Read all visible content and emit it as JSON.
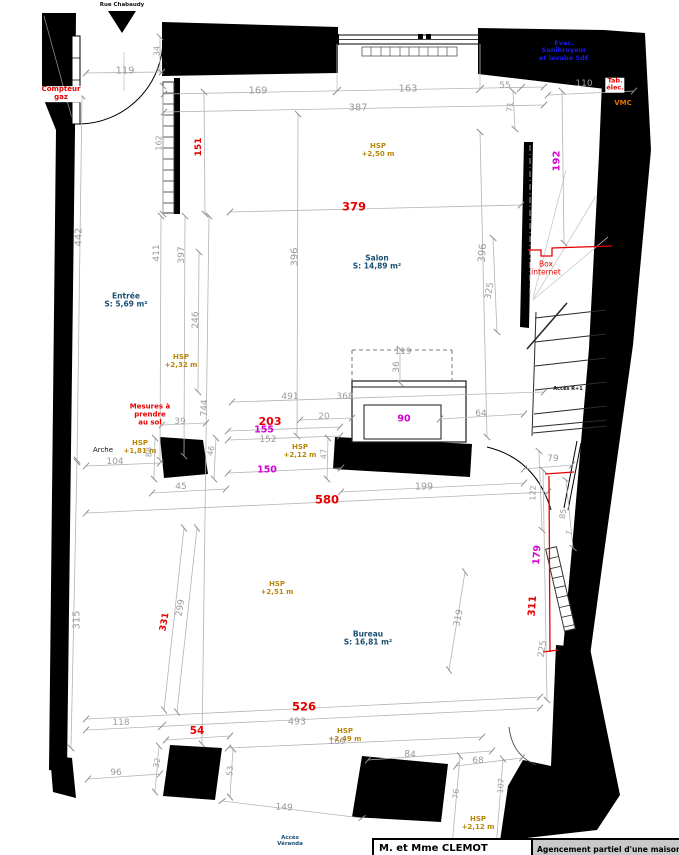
{
  "colors": {
    "dim": "#9b9b9b",
    "red": "#e60000",
    "magenta": "#d400d4",
    "hsp": "#b8860b",
    "room": "#1b4f72",
    "blue": "#1a1ae6",
    "orange": "#e67300",
    "black": "#111111"
  },
  "title_block": {
    "client": "M. et Mme CLEMOT",
    "project": "Agencement partiel d'une maison d'hab"
  },
  "labels": [
    {
      "name": "street-label",
      "text": "Rue Chabaudy",
      "x": 122,
      "y": 5,
      "color": "black",
      "size": 5.5,
      "bold": true
    },
    {
      "name": "compteur-gaz-label",
      "text": "Compteur\ngaz",
      "x": 61,
      "y": 94,
      "color": "red",
      "size": 7,
      "bold": true,
      "bg": true
    },
    {
      "name": "dim-119-top",
      "text": "119",
      "x": 125,
      "y": 71,
      "color": "dim",
      "size": 10
    },
    {
      "name": "dim-34",
      "text": "34",
      "x": 158,
      "y": 51,
      "color": "dim",
      "size": 8,
      "rot": -90
    },
    {
      "name": "dim-169-top",
      "text": "169",
      "x": 258,
      "y": 91,
      "color": "dim",
      "size": 10
    },
    {
      "name": "dim-163",
      "text": "163",
      "x": 408,
      "y": 89,
      "color": "dim",
      "size": 10
    },
    {
      "name": "dim-55",
      "text": "55",
      "x": 505,
      "y": 86,
      "color": "dim",
      "size": 9
    },
    {
      "name": "dim-110",
      "text": "110",
      "x": 584,
      "y": 84,
      "color": "dim",
      "size": 9
    },
    {
      "name": "dim-387",
      "text": "387",
      "x": 358,
      "y": 108,
      "color": "dim",
      "size": 10
    },
    {
      "name": "dim-71",
      "text": "71",
      "x": 511,
      "y": 107,
      "color": "dim",
      "size": 8,
      "rot": -85
    },
    {
      "name": "evac-note",
      "text": "Evac.\nSanibroyeur\net lavabo SdE",
      "x": 564,
      "y": 51,
      "color": "blue",
      "size": 6.5,
      "bold": true
    },
    {
      "name": "tab-elec-label",
      "text": "Tab.\nélec.",
      "x": 615,
      "y": 85,
      "color": "red",
      "size": 6.5,
      "bold": true,
      "bg": true
    },
    {
      "name": "vmc-label",
      "text": "VMC",
      "x": 623,
      "y": 104,
      "color": "orange",
      "size": 7,
      "bold": true
    },
    {
      "name": "dim-162",
      "text": "162",
      "x": 160,
      "y": 143,
      "color": "dim",
      "size": 8,
      "rot": -90
    },
    {
      "name": "dim-151",
      "text": "151",
      "x": 199,
      "y": 147,
      "color": "red",
      "size": 9,
      "rot": -90,
      "bold": true
    },
    {
      "name": "dim-192",
      "text": "192",
      "x": 557,
      "y": 161,
      "color": "magenta",
      "size": 10,
      "rot": -90,
      "bold": true
    },
    {
      "name": "hsp-salon",
      "text": "HSP\n+2,50 m",
      "x": 378,
      "y": 151,
      "color": "hsp",
      "size": 7,
      "bold": true
    },
    {
      "name": "dim-379",
      "text": "379",
      "x": 354,
      "y": 207,
      "color": "red",
      "size": 11.5,
      "bold": true
    },
    {
      "name": "dim-442",
      "text": "442",
      "x": 79,
      "y": 237,
      "color": "dim",
      "size": 10,
      "rot": -90
    },
    {
      "name": "dim-411",
      "text": "411",
      "x": 157,
      "y": 253,
      "color": "dim",
      "size": 9,
      "rot": -90
    },
    {
      "name": "dim-397",
      "text": "397",
      "x": 182,
      "y": 255,
      "color": "dim",
      "size": 9,
      "rot": -90
    },
    {
      "name": "dim-396-left",
      "text": "396",
      "x": 295,
      "y": 257,
      "color": "dim",
      "size": 10,
      "rot": -90
    },
    {
      "name": "dim-396-right",
      "text": "396",
      "x": 483,
      "y": 253,
      "color": "dim",
      "size": 10,
      "rot": -86
    },
    {
      "name": "dim-325",
      "text": "325",
      "x": 490,
      "y": 291,
      "color": "dim",
      "size": 9,
      "rot": -80
    },
    {
      "name": "room-label-salon",
      "text": "Salon\nS: 14,89 m²",
      "x": 377,
      "y": 263,
      "color": "room",
      "size": 7.5,
      "bold": true
    },
    {
      "name": "room-label-entree",
      "text": "Entrée\nS: 5,69 m²",
      "x": 126,
      "y": 301,
      "color": "room",
      "size": 7.5,
      "bold": true
    },
    {
      "name": "box-internet-label",
      "text": "Box\ninternet",
      "x": 546,
      "y": 269,
      "color": "red",
      "size": 7.5
    },
    {
      "name": "dim-246",
      "text": "246",
      "x": 196,
      "y": 320,
      "color": "dim",
      "size": 9,
      "rot": -90
    },
    {
      "name": "hsp-entree",
      "text": "HSP\n+2,32 m",
      "x": 181,
      "y": 362,
      "color": "hsp",
      "size": 7,
      "bold": true
    },
    {
      "name": "dim-36",
      "text": "36",
      "x": 397,
      "y": 367,
      "color": "dim",
      "size": 9,
      "rot": -90
    },
    {
      "name": "acces-r1-label",
      "text": "Accès R+1",
      "x": 568,
      "y": 390,
      "color": "black",
      "size": 5,
      "bold": true
    },
    {
      "name": "dim-491",
      "text": "491",
      "x": 290,
      "y": 397,
      "color": "dim",
      "size": 9
    },
    {
      "name": "dim-368",
      "text": "368",
      "x": 345,
      "y": 397,
      "color": "dim",
      "size": 9
    },
    {
      "name": "dim-119-fireplace",
      "text": "119",
      "x": 403,
      "y": 352,
      "color": "dim",
      "size": 9
    },
    {
      "name": "dim-744",
      "text": "744",
      "x": 205,
      "y": 408,
      "color": "dim",
      "size": 9,
      "rot": -88
    },
    {
      "name": "mesures-note",
      "text": "Mesures à\nprendre\nau sol",
      "x": 150,
      "y": 415,
      "color": "red",
      "size": 7,
      "bold": true
    },
    {
      "name": "dim-39",
      "text": "39",
      "x": 180,
      "y": 422,
      "color": "dim",
      "size": 9
    },
    {
      "name": "dim-20",
      "text": "20",
      "x": 324,
      "y": 417,
      "color": "dim",
      "size": 9
    },
    {
      "name": "dim-90",
      "text": "90",
      "x": 404,
      "y": 420,
      "color": "magenta",
      "size": 9.5,
      "bold": true
    },
    {
      "name": "dim-64",
      "text": "64",
      "x": 481,
      "y": 414,
      "color": "dim",
      "size": 9
    },
    {
      "name": "dim-203",
      "text": "203",
      "x": 270,
      "y": 422,
      "color": "red",
      "size": 11,
      "bold": true
    },
    {
      "name": "dim-155",
      "text": "155",
      "x": 264,
      "y": 431,
      "color": "magenta",
      "size": 9.5,
      "bold": true
    },
    {
      "name": "dim-152",
      "text": "152",
      "x": 268,
      "y": 440,
      "color": "dim",
      "size": 9
    },
    {
      "name": "arche-label",
      "text": "Arche",
      "x": 103,
      "y": 451,
      "color": "black",
      "size": 7
    },
    {
      "name": "hsp-arche",
      "text": "HSP\n+1,81 m",
      "x": 140,
      "y": 448,
      "color": "hsp",
      "size": 7,
      "bold": true
    },
    {
      "name": "dim-104",
      "text": "104",
      "x": 115,
      "y": 462,
      "color": "dim",
      "size": 9
    },
    {
      "name": "dim-88",
      "text": "88",
      "x": 150,
      "y": 452,
      "color": "dim",
      "size": 8,
      "rot": -90
    },
    {
      "name": "dim-46",
      "text": "46",
      "x": 212,
      "y": 451,
      "color": "dim",
      "size": 8,
      "rot": -78
    },
    {
      "name": "hsp-passage",
      "text": "HSP\n+2,12 m",
      "x": 300,
      "y": 452,
      "color": "hsp",
      "size": 7,
      "bold": true
    },
    {
      "name": "dim-47",
      "text": "47",
      "x": 325,
      "y": 454,
      "color": "dim",
      "size": 8,
      "rot": -90
    },
    {
      "name": "dim-79",
      "text": "79",
      "x": 553,
      "y": 459,
      "color": "dim",
      "size": 9
    },
    {
      "name": "dim-150",
      "text": "150",
      "x": 267,
      "y": 471,
      "color": "magenta",
      "size": 9.5,
      "bold": true
    },
    {
      "name": "dim-45",
      "text": "45",
      "x": 181,
      "y": 487,
      "color": "dim",
      "size": 9
    },
    {
      "name": "dim-199",
      "text": "199",
      "x": 424,
      "y": 488,
      "color": "dim",
      "size": 9.5
    },
    {
      "name": "dim-122",
      "text": "122",
      "x": 534,
      "y": 493,
      "color": "dim",
      "size": 8,
      "rot": -88
    },
    {
      "name": "dim-580",
      "text": "580",
      "x": 327,
      "y": 500,
      "color": "red",
      "size": 11.5,
      "bold": true
    },
    {
      "name": "dim-85",
      "text": "85",
      "x": 564,
      "y": 514,
      "color": "dim",
      "size": 8,
      "rot": -80
    },
    {
      "name": "dim-7",
      "text": "7",
      "x": 570,
      "y": 533,
      "color": "dim",
      "size": 7,
      "rot": -80
    },
    {
      "name": "dim-179",
      "text": "179",
      "x": 538,
      "y": 555,
      "color": "magenta",
      "size": 9.5,
      "rot": -86,
      "bold": true
    },
    {
      "name": "dim-315",
      "text": "315",
      "x": 77,
      "y": 620,
      "color": "dim",
      "size": 10,
      "rot": -90
    },
    {
      "name": "dim-299",
      "text": "299",
      "x": 181,
      "y": 608,
      "color": "dim",
      "size": 9,
      "rot": -80
    },
    {
      "name": "dim-331",
      "text": "331",
      "x": 165,
      "y": 622,
      "color": "red",
      "size": 9,
      "rot": -80,
      "bold": true
    },
    {
      "name": "dim-311",
      "text": "311",
      "x": 533,
      "y": 606,
      "color": "red",
      "size": 10,
      "rot": -86,
      "bold": true
    },
    {
      "name": "dim-319",
      "text": "319",
      "x": 459,
      "y": 618,
      "color": "dim",
      "size": 9,
      "rot": -78
    },
    {
      "name": "hsp-bureau",
      "text": "HSP\n+2,51 m",
      "x": 277,
      "y": 589,
      "color": "hsp",
      "size": 7,
      "bold": true
    },
    {
      "name": "room-label-bureau",
      "text": "Bureau\nS: 16,81 m²",
      "x": 368,
      "y": 639,
      "color": "room",
      "size": 7.5,
      "bold": true
    },
    {
      "name": "dim-225",
      "text": "225",
      "x": 543,
      "y": 649,
      "color": "dim",
      "size": 9,
      "rot": -80
    },
    {
      "name": "dim-526",
      "text": "526",
      "x": 304,
      "y": 707,
      "color": "red",
      "size": 11.5,
      "bold": true
    },
    {
      "name": "dim-493",
      "text": "493",
      "x": 297,
      "y": 723,
      "color": "dim",
      "size": 9.5
    },
    {
      "name": "dim-118",
      "text": "118",
      "x": 121,
      "y": 723,
      "color": "dim",
      "size": 9
    },
    {
      "name": "dim-54",
      "text": "54",
      "x": 197,
      "y": 732,
      "color": "red",
      "size": 10.5,
      "bold": true
    },
    {
      "name": "hsp-veranda",
      "text": "HSP\n+2,49 m",
      "x": 345,
      "y": 736,
      "color": "hsp",
      "size": 7,
      "bold": true
    },
    {
      "name": "dim-169-bottom",
      "text": "169",
      "x": 337,
      "y": 742,
      "color": "dim",
      "size": 9
    },
    {
      "name": "dim-84",
      "text": "84",
      "x": 410,
      "y": 755,
      "color": "dim",
      "size": 9,
      "rot": 4
    },
    {
      "name": "dim-68",
      "text": "68",
      "x": 478,
      "y": 761,
      "color": "dim",
      "size": 9
    },
    {
      "name": "dim-96",
      "text": "96",
      "x": 116,
      "y": 773,
      "color": "dim",
      "size": 9
    },
    {
      "name": "dim-32",
      "text": "32",
      "x": 158,
      "y": 763,
      "color": "dim",
      "size": 8,
      "rot": -80
    },
    {
      "name": "dim-53",
      "text": "53",
      "x": 231,
      "y": 771,
      "color": "dim",
      "size": 8,
      "rot": -85
    },
    {
      "name": "dim-76",
      "text": "76",
      "x": 457,
      "y": 794,
      "color": "dim",
      "size": 8,
      "rot": -85
    },
    {
      "name": "dim-107",
      "text": "107",
      "x": 502,
      "y": 786,
      "color": "dim",
      "size": 8,
      "rot": -85
    },
    {
      "name": "dim-149",
      "text": "149",
      "x": 284,
      "y": 808,
      "color": "dim",
      "size": 9,
      "rot": 4
    },
    {
      "name": "acces-veranda-label",
      "text": "Accès\nVéranda",
      "x": 290,
      "y": 841,
      "color": "room",
      "size": 5.5,
      "bold": true
    },
    {
      "name": "hsp-bas",
      "text": "HSP\n+2,12 m",
      "x": 478,
      "y": 824,
      "color": "hsp",
      "size": 7,
      "bold": true
    }
  ]
}
